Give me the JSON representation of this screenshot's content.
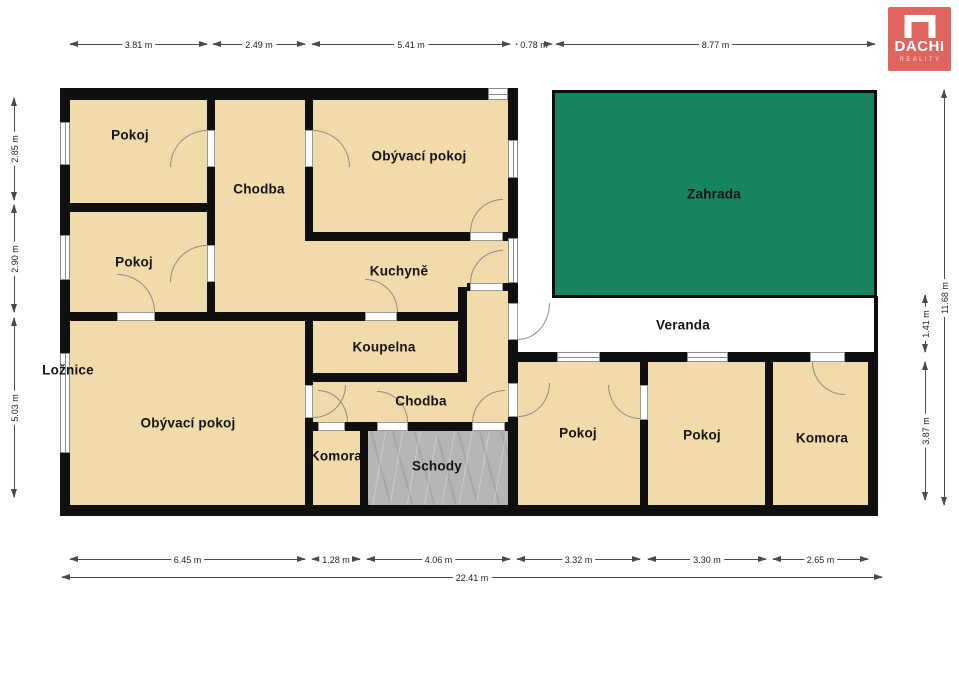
{
  "plan": {
    "rooms": {
      "pokoj_top_left": "Pokoj",
      "chodba_top": "Chodba",
      "obyvaci_pokoj_top": "Obývací pokoj",
      "pokoj_mid_left": "Pokoj",
      "kuchyne": "Kuchyně",
      "koupelna": "Koupelna",
      "loznice": "Ložnice",
      "obyvaci_pokoj_main": "Obývací pokoj",
      "chodba_lower": "Chodba",
      "komora_inner": "Komora",
      "schody": "Schody",
      "pokoj_wing_1": "Pokoj",
      "pokoj_wing_2": "Pokoj",
      "komora_wing": "Komora",
      "zahrada": "Zahrada",
      "veranda": "Veranda"
    },
    "dimensions_m": {
      "top": [
        "3.81 m",
        "2.49 m",
        "5.41 m",
        "0.78 m",
        "8.77 m"
      ],
      "left": [
        "2.85 m",
        "2.90 m",
        "5.03 m"
      ],
      "right_outer": "11.68 m",
      "right_inner": [
        "1.41 m",
        "3.87 m"
      ],
      "bottom": [
        "6.45 m",
        "1.28 m",
        "4.06 m",
        "3.32 m",
        "3.30 m",
        "2.65 m"
      ],
      "bottom_total": "22.41 m"
    },
    "colors": {
      "wall": "#101010",
      "room_fill": "#f2dbaa",
      "garden_green": "#16855d",
      "stairs_gray": "#b5b5b5",
      "logo_red": "#e0655f"
    }
  },
  "logo": {
    "title": "DACHI",
    "subtitle": "REALITY"
  }
}
